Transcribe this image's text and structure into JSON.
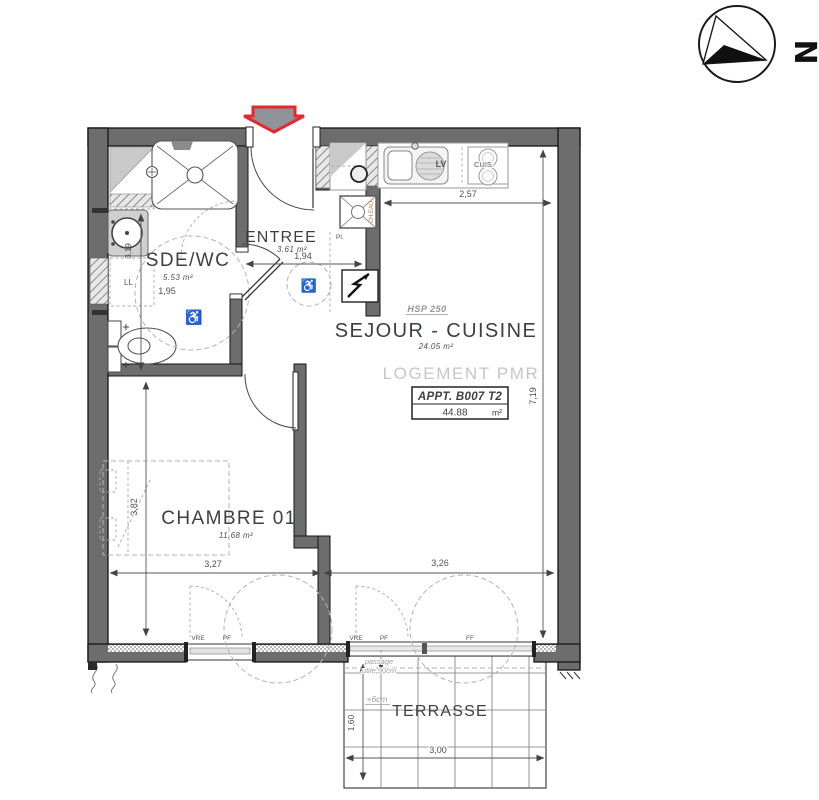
{
  "compass": {
    "north": "N"
  },
  "apartment": {
    "pmr_label": "LOGEMENT PMR",
    "ref": "APPT. B007 T2",
    "total_area": "44.88",
    "area_unit": "m²",
    "ceiling_height": "HSP 250"
  },
  "rooms": {
    "sdewc": {
      "name": "SDE/WC",
      "area": "5.53 m²"
    },
    "entree": {
      "name": "ENTREE",
      "area": "3.61 m²"
    },
    "sejour": {
      "name": "SEJOUR - CUISINE",
      "area": "24.05 m²"
    },
    "chambre": {
      "name": "CHAMBRE 01",
      "area": "11.68 m²"
    },
    "terrasse": {
      "name": "TERRASSE"
    }
  },
  "dimensions": {
    "kitchen_width": "2,57",
    "entree_width": "1,94",
    "sdewc_width": "1,95",
    "sdewc_depth": "3,19",
    "interior_depth": "7,19",
    "chambre_width": "3,27",
    "sejour_width": "3,26",
    "chambre_depth": "3,82",
    "terrasse_width": "3,00",
    "terrasse_depth": "1,60"
  },
  "fixtures": {
    "dishwasher": "LV",
    "cooktop": "CUIS.",
    "closet": "Pl.",
    "washer": "LL",
    "water_heater": "CH.EAU"
  },
  "windows": {
    "w1_shutter": "VRE",
    "w1_type": "PF",
    "w2_shutter": "VRE",
    "w2_type": "PF",
    "w2_fixed": "FF"
  },
  "terrasse_notes": {
    "passage_l1": "passage",
    "passage_l2": "utile 90cm",
    "level": "+6cm"
  }
}
